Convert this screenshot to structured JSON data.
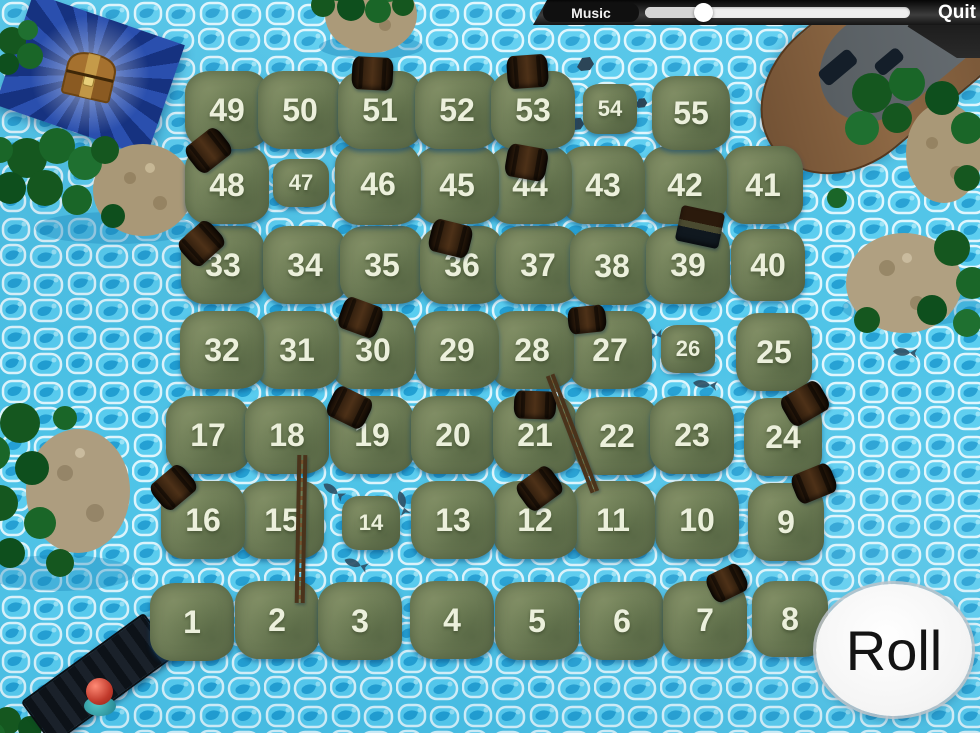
{
  "topbar": {
    "music_label": "Music",
    "quit_label": "Quit",
    "music_volume_pct": 22
  },
  "roll_button": {
    "label": "Roll"
  },
  "board": {
    "tiles": [
      "1",
      "2",
      "3",
      "4",
      "5",
      "6",
      "7",
      "8",
      "9",
      "10",
      "11",
      "12",
      "13",
      "14",
      "15",
      "16",
      "17",
      "18",
      "19",
      "20",
      "21",
      "22",
      "23",
      "24",
      "25",
      "26",
      "27",
      "28",
      "29",
      "30",
      "31",
      "32",
      "33",
      "34",
      "35",
      "36",
      "37",
      "38",
      "39",
      "40",
      "41",
      "42",
      "43",
      "44",
      "45",
      "46",
      "47",
      "48",
      "49",
      "50",
      "51",
      "52",
      "53",
      "54",
      "55"
    ]
  },
  "icons": [
    "treasure-chest-icon",
    "boat-icon",
    "dock-icon",
    "player-piece-icon",
    "barrel-icon",
    "crate-icon",
    "ladder-icon",
    "tree-icon",
    "rock-icon",
    "fish-icon"
  ],
  "colors": {
    "water": "#4cc3e7",
    "tile_grass": "#72805a",
    "tile_number": "#ecf0dc",
    "topbar": "#2b2b2b",
    "slider_track": "#efefef",
    "roll_background": "#ffffff",
    "roll_text": "#141414",
    "treasure_banner": "#1d3e92"
  }
}
